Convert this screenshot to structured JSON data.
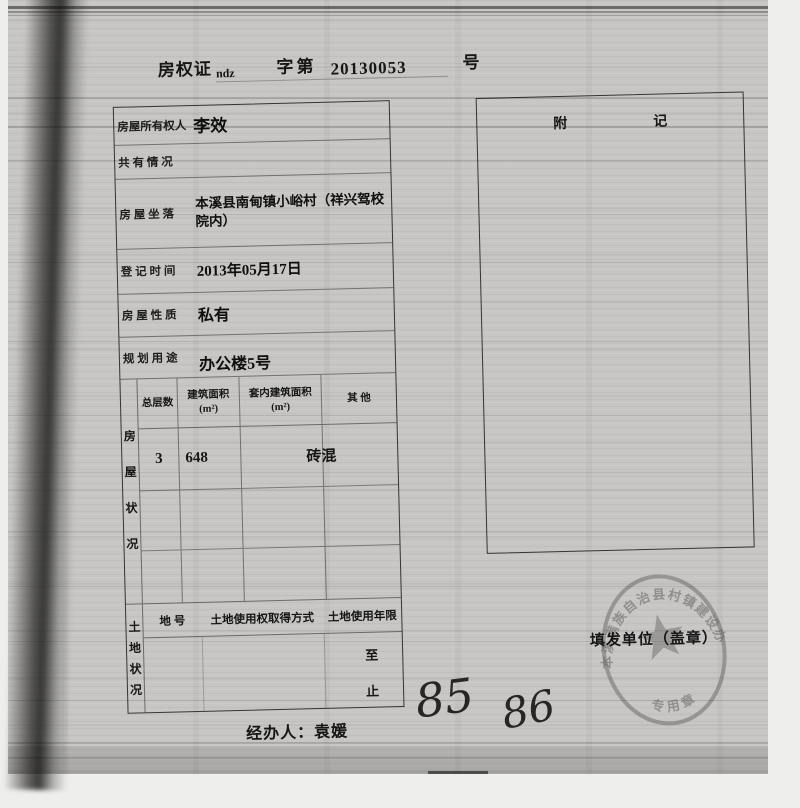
{
  "title": {
    "part1": "房权证",
    "part2": "ndz",
    "part3": "字第",
    "part4": "20130053",
    "part5": "号"
  },
  "owner_table": {
    "rows": [
      {
        "label": "房屋所有权人",
        "value": "李效"
      },
      {
        "label": "共 有 情 况",
        "value": ""
      },
      {
        "label": "房 屋 坐 落",
        "value": "本溪县南甸镇小峪村（祥兴驾校院内）"
      },
      {
        "label": "登 记 时 间",
        "value": "2013年05月17日"
      },
      {
        "label": "房 屋 性 质",
        "value": "私有"
      },
      {
        "label": "规 划 用 途",
        "value": "办公楼5号"
      }
    ]
  },
  "house_status": {
    "side_label": "房屋状况",
    "col1": "总层数",
    "col2_line1": "建筑面积",
    "col2_line2": "(m²)",
    "col3_line1": "套内建筑面积",
    "col3_line2": "(m²)",
    "col4": "其 他",
    "values": {
      "floors": "3",
      "area": "648",
      "inner": "",
      "other": "砖混"
    }
  },
  "land_status": {
    "side_label": "土地状况",
    "col1": "地 号",
    "col2": "土地使用权取得方式",
    "col3": "土地使用年限",
    "marker_to": "至",
    "marker_end": "止"
  },
  "annex": {
    "left_char": "附",
    "right_char": "记"
  },
  "issuer": {
    "label": "填发单位（盖章）",
    "seal_arc_text": "本溪满族自治县村镇建设办",
    "seal_bottom_text": "专用章"
  },
  "handler": {
    "label": "经办人：",
    "name": "袁媛"
  },
  "handwriting": {
    "first": "85",
    "second": "86"
  }
}
